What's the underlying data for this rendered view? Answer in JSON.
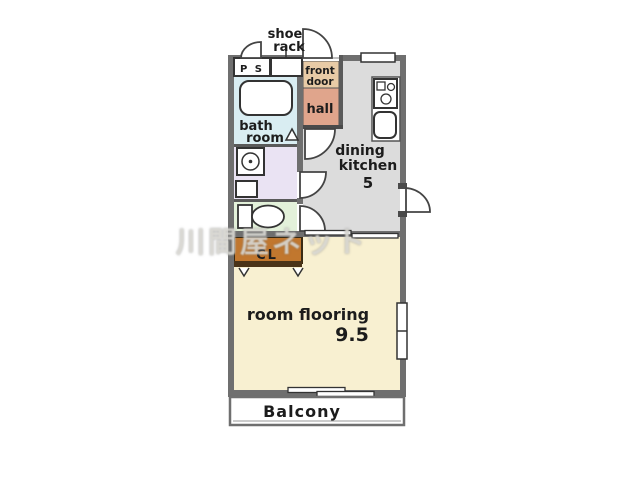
{
  "title": "apartment floor plan",
  "colors": {
    "wall": "#6f6f6f",
    "bath_room": "#d9edf2",
    "wash_room": "#eae3f3",
    "toilet": "#e3f1da",
    "front_door": "#e8cba6",
    "hall": "#e0a58c",
    "dining_kitchen": "#dcdcdc",
    "closet": "#c1772e",
    "room_flooring": "#f8f0d1",
    "balcony": "#ffffff"
  },
  "rooms": {
    "shoe_rack": {
      "line1": "shoe",
      "line2": "rack"
    },
    "pipe_space": {
      "label": "P S"
    },
    "front_door": {
      "line1": "front",
      "line2": "door"
    },
    "hall": {
      "label": "hall"
    },
    "bath_room": {
      "line1": "bath",
      "line2": "room"
    },
    "dining_kitchen": {
      "line1": "dining",
      "line2": "kitchen",
      "size": "5"
    },
    "closet": {
      "label": "CL"
    },
    "room_flooring": {
      "label": "room flooring",
      "size": "9.5"
    },
    "balcony": {
      "label": "Balcony"
    }
  },
  "watermark": {
    "text": "川間屋ネット"
  }
}
